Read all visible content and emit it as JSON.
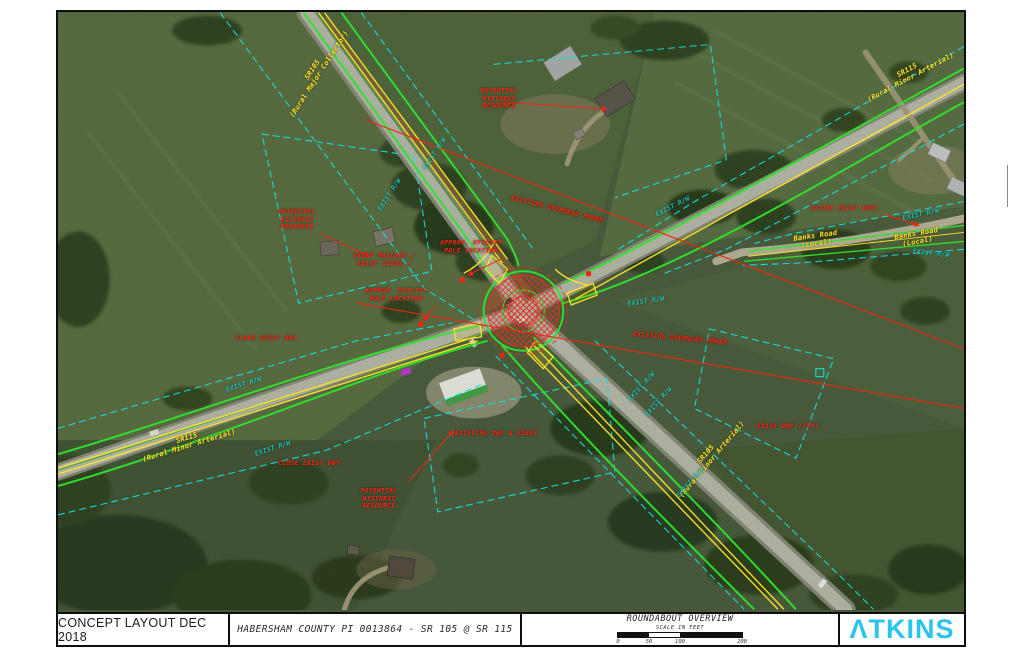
{
  "title_block": {
    "revision": "CONCEPT LAYOUT DEC 2018",
    "project": "HABERSHAM COUNTY PI 0013864 - SR 105 @ SR 115",
    "drawing_title": "ROUNDABOUT OVERVIEW",
    "scale_label": "SCALE IN FEET",
    "scale_ticks": [
      "0",
      "50",
      "100",
      "200"
    ],
    "scale_max_feet": 200,
    "logo": "ATKINS",
    "logo_display": "ΛTKINS"
  },
  "colors": {
    "rw_cyan": "#16e4e4",
    "marking_yellow": "#ffe42a",
    "callout_red": "#ff2516",
    "proposed_green": "#2ee32e",
    "logo_cyan": "#29c5ee",
    "roundabout_hatch_red": "#e03020"
  },
  "map": {
    "north_arrow": "north-arrow",
    "labels": [
      {
        "name": "road-label-sr105-nw",
        "cls": "yellow",
        "x": 258,
        "y": 60,
        "rot": -57,
        "text": "SR105\n(Rural Major Collector)"
      },
      {
        "name": "road-label-sr115-ne",
        "cls": "yellow",
        "x": 851,
        "y": 62,
        "rot": -28,
        "text": "SR115\n(Rural Minor Arterial)"
      },
      {
        "name": "road-label-sr115-sw",
        "cls": "yellow",
        "x": 130,
        "y": 430,
        "rot": -17,
        "text": "SR115\n(Rural Minor Arterial)"
      },
      {
        "name": "road-label-sr105-se",
        "cls": "yellow",
        "x": 651,
        "y": 445,
        "rot": -50,
        "text": "SR105\n(Rural Minor Arterial)"
      },
      {
        "name": "road-label-banks-road-1",
        "cls": "yellow",
        "x": 758,
        "y": 228,
        "rot": -8,
        "text": "Banks Road\n(Local)"
      },
      {
        "name": "road-label-banks-road-2",
        "cls": "yellow",
        "x": 859,
        "y": 226,
        "rot": -10,
        "text": "Banks Road\n(Local)"
      },
      {
        "name": "rw-label-1",
        "cls": "cyan",
        "x": 377,
        "y": 142,
        "rot": -57,
        "text": "EXIST R/W"
      },
      {
        "name": "rw-label-2",
        "cls": "cyan",
        "x": 332,
        "y": 183,
        "rot": -57,
        "text": "EXIST R/W"
      },
      {
        "name": "rw-label-3",
        "cls": "cyan",
        "x": 615,
        "y": 195,
        "rot": -27,
        "text": "EXIST R/W"
      },
      {
        "name": "rw-label-4",
        "cls": "cyan",
        "x": 863,
        "y": 203,
        "rot": -12,
        "text": "EXIST R/W"
      },
      {
        "name": "rw-label-5",
        "cls": "cyan",
        "x": 873,
        "y": 242,
        "rot": 6,
        "text": "EXIST R/W"
      },
      {
        "name": "rw-label-6",
        "cls": "cyan",
        "x": 588,
        "y": 290,
        "rot": -8,
        "text": "EXIST R/W"
      },
      {
        "name": "rw-label-7",
        "cls": "cyan",
        "x": 584,
        "y": 375,
        "rot": -48,
        "text": "EXIST R/W"
      },
      {
        "name": "rw-label-8",
        "cls": "cyan",
        "x": 601,
        "y": 390,
        "rot": -48,
        "text": "EXIST R/W"
      },
      {
        "name": "rw-label-9",
        "cls": "cyan",
        "x": 186,
        "y": 373,
        "rot": -18,
        "text": "EXIST R/W"
      },
      {
        "name": "rw-label-10",
        "cls": "cyan",
        "x": 215,
        "y": 437,
        "rot": -18,
        "text": "EXIST R/W"
      },
      {
        "name": "rw-label-11",
        "cls": "cyan",
        "x": 633,
        "y": 471,
        "rot": -48,
        "text": "EXIST R/W"
      },
      {
        "name": "callout-potential-historic-resource-west",
        "cls": "red",
        "x": 239,
        "y": 208,
        "rot": 0,
        "text": "POTENTIAL\nHISTORIC\nRESOURCE"
      },
      {
        "name": "callout-potential-historic-resource-north",
        "cls": "red",
        "x": 441,
        "y": 87,
        "rot": 0,
        "text": "POTENTIAL\nHISTORIC\nRESOURCE"
      },
      {
        "name": "callout-potential-historic-resource-south",
        "cls": "red",
        "x": 321,
        "y": 487,
        "rot": 0,
        "text": "POTENTIAL\nHISTORIC\nRESOURCE"
      },
      {
        "name": "callout-exist-mailbox-signs",
        "cls": "red",
        "x": 326,
        "y": 248,
        "rot": 0,
        "text": "EXIST MAILBOX /\nEXIST SIGNS /"
      },
      {
        "name": "callout-utility-pole-ne",
        "cls": "red",
        "x": 413,
        "y": 235,
        "rot": 0,
        "text": "APPROX. UTILITY\nPOLE LOCATION"
      },
      {
        "name": "callout-utility-pole-sw",
        "cls": "red",
        "x": 338,
        "y": 283,
        "rot": 0,
        "text": "APPROX. UTILITY\nPOLE LOCATION"
      },
      {
        "name": "callout-overhead-power-1",
        "cls": "red",
        "x": 499,
        "y": 198,
        "rot": 14,
        "text": "EXISTING OVERHEAD POWER"
      },
      {
        "name": "callout-overhead-power-2",
        "cls": "red",
        "x": 622,
        "y": 327,
        "rot": 5,
        "text": "EXISTING OVERHEAD POWER"
      },
      {
        "name": "callout-close-exist-dwy-1",
        "cls": "red",
        "x": 208,
        "y": 327,
        "rot": 0,
        "text": "CLOSE EXIST DWY"
      },
      {
        "name": "callout-existing-dwy-signs",
        "cls": "red",
        "x": 438,
        "y": 422,
        "rot": 0,
        "text": "EXISTING DWY & SIGNS"
      },
      {
        "name": "callout-close-exist-dwy-2",
        "cls": "red",
        "x": 251,
        "y": 452,
        "rot": 0,
        "text": "CLOSE EXIST DWY"
      },
      {
        "name": "callout-exist-dwy-typ",
        "cls": "red",
        "x": 730,
        "y": 415,
        "rot": 0,
        "text": "EXIST DWY (TYP)"
      },
      {
        "name": "callout-close-exist-dwy-banks",
        "cls": "red",
        "x": 786,
        "y": 197,
        "rot": 0,
        "text": "(CLOSE EXIST DWY)"
      }
    ]
  }
}
